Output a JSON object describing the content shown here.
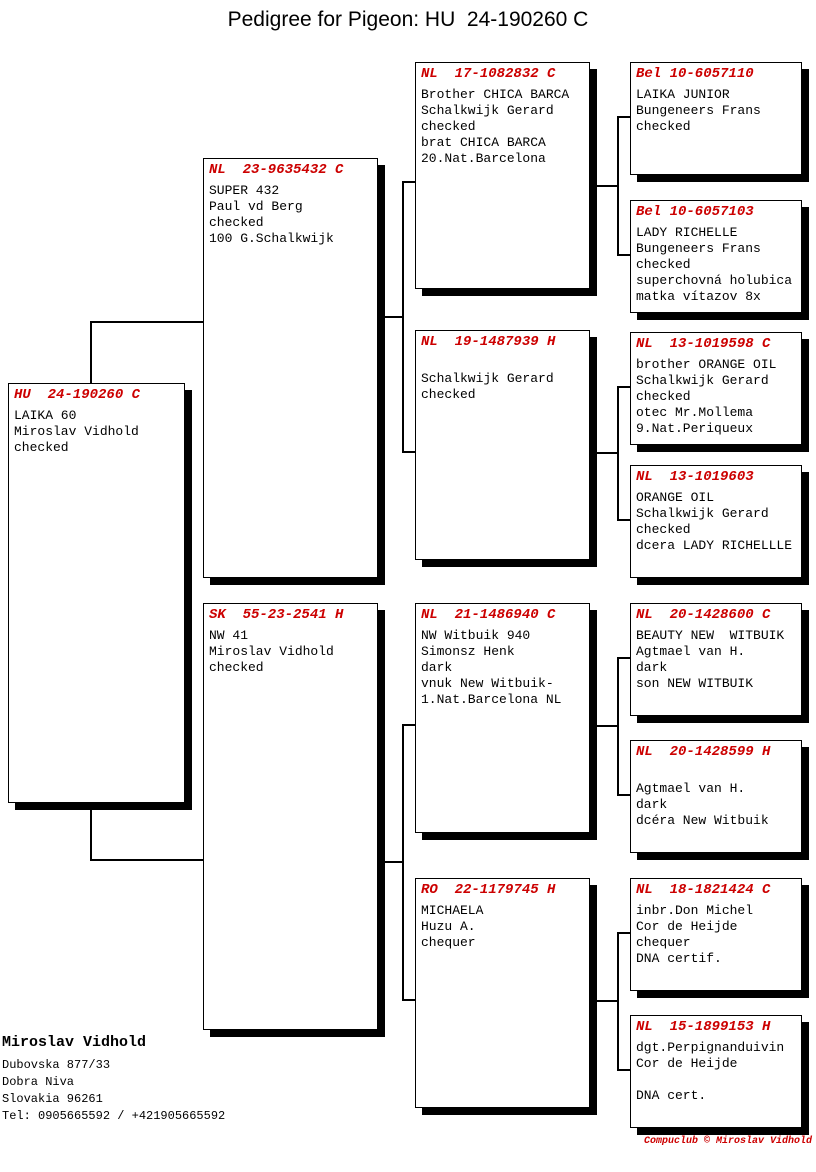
{
  "title": "Pedigree for Pigeon: HU  24-190260 C",
  "accent_color": "#cc0000",
  "boxes": [
    {
      "role": "subject",
      "ring": "HU  24-190260 C",
      "details": "LAIKA 60\nMiroslav Vidhold\nchecked"
    },
    {
      "role": "sire",
      "ring": "NL  23-9635432 C",
      "details": "SUPER 432\nPaul vd Berg\nchecked\n100 G.Schalkwijk"
    },
    {
      "role": "dam",
      "ring": "SK  55-23-2541 H",
      "details": "NW 41\nMiroslav Vidhold\nchecked"
    },
    {
      "role": "sire-sire",
      "ring": "NL  17-1082832 C",
      "details": "Brother CHICA BARCA\nSchalkwijk Gerard\nchecked\nbrat CHICA BARCA\n20.Nat.Barcelona"
    },
    {
      "role": "sire-dam",
      "ring": "NL  19-1487939 H",
      "details": "\nSchalkwijk Gerard\nchecked"
    },
    {
      "role": "dam-sire",
      "ring": "NL  21-1486940 C",
      "details": "NW Witbuik 940\nSimonsz Henk\ndark\nvnuk New Witbuik-\n1.Nat.Barcelona NL"
    },
    {
      "role": "dam-dam",
      "ring": "RO  22-1179745 H",
      "details": "MICHAELA\nHuzu A.\nchequer"
    },
    {
      "role": "sire-sire-sire",
      "ring": "Bel 10-6057110",
      "details": "LAIKA JUNIOR\nBungeneers Frans\nchecked"
    },
    {
      "role": "sire-sire-dam",
      "ring": "Bel 10-6057103",
      "details": "LADY RICHELLE\nBungeneers Frans\nchecked\nsuperchovná holubica\nmatka vítazov 8x"
    },
    {
      "role": "sire-dam-sire",
      "ring": "NL  13-1019598 C",
      "details": "brother ORANGE OIL\nSchalkwijk Gerard\nchecked\notec Mr.Mollema\n9.Nat.Periqueux"
    },
    {
      "role": "sire-dam-dam",
      "ring": "NL  13-1019603",
      "details": "ORANGE OIL\nSchalkwijk Gerard\nchecked\ndcera LADY RICHELLLE"
    },
    {
      "role": "dam-sire-sire",
      "ring": "NL  20-1428600 C",
      "details": "BEAUTY NEW  WITBUIK\nAgtmael van H.\ndark\nson NEW WITBUIK"
    },
    {
      "role": "dam-sire-dam",
      "ring": "NL  20-1428599 H",
      "details": "\nAgtmael van H.\ndark\ndcéra New Witbuik"
    },
    {
      "role": "dam-dam-sire",
      "ring": "NL  18-1821424 C",
      "details": "inbr.Don Michel\nCor de Heijde\nchequer\nDNA certif."
    },
    {
      "role": "dam-dam-dam",
      "ring": "NL  15-1899153 H",
      "details": "dgt.Perpignanduivin\nCor de Heijde\n\nDNA cert."
    }
  ],
  "owner": {
    "name": "Miroslav Vidhold",
    "address": "Dubovska 877/33\nDobra Niva\nSlovakia 96261\nTel: 0905665592 / +421905665592"
  },
  "footer_credit": "Compuclub © Miroslav Vidhold"
}
